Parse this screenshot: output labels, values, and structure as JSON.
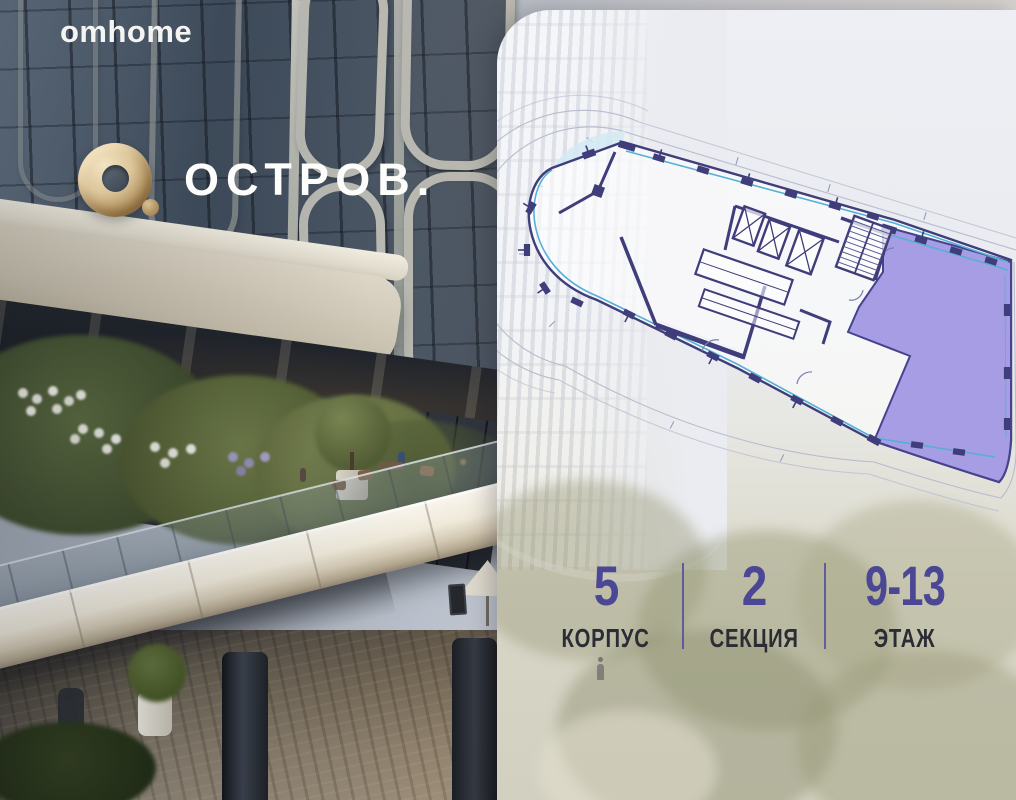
{
  "brand": {
    "name": "omhome"
  },
  "project": {
    "logo_text": "ОСТРОВ.",
    "logo_icon": "gold-torus-o-icon"
  },
  "panel": {
    "stats": [
      {
        "value": "5",
        "label": "КОРПУС"
      },
      {
        "value": "2",
        "label": "СЕКЦИЯ"
      },
      {
        "value": "9-13",
        "label": "ЭТАЖ"
      }
    ]
  },
  "floor_plan": {
    "type": "building-floor-plan",
    "highlighted_section_color": "#a79de5",
    "wall_color": "#3f3d7a",
    "glazing_color": "#54b0d4",
    "outline_color": "#b7bccf"
  },
  "colors": {
    "accent_number": "#4b4794",
    "label_dark": "#2c2c34",
    "divider": "#57529e",
    "logo_gold": "#c8ab79"
  }
}
